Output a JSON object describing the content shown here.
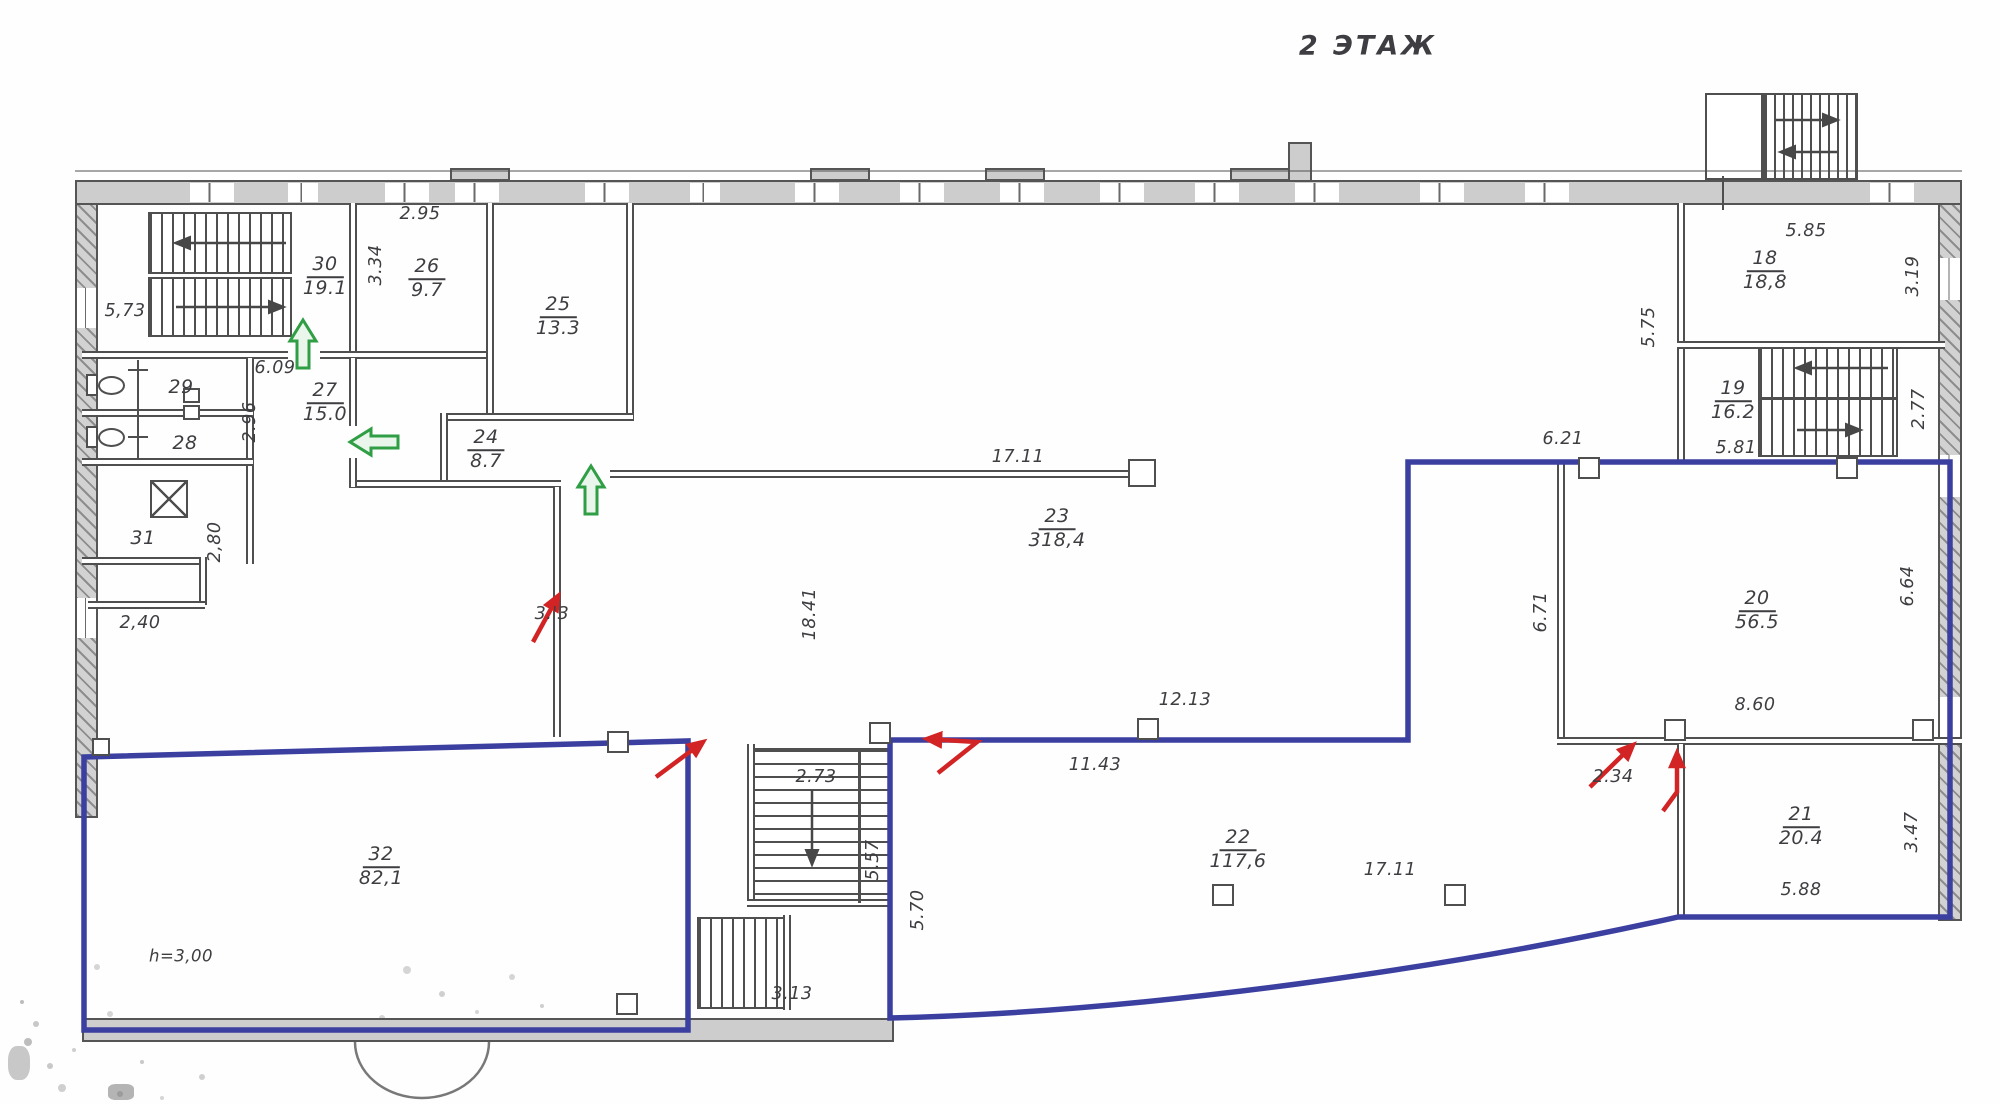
{
  "title": "2 ЭТАЖ",
  "rooms": {
    "r18": {
      "num": "18",
      "area": "18,8"
    },
    "r19": {
      "num": "19",
      "area": "16.2"
    },
    "r20": {
      "num": "20",
      "area": "56.5"
    },
    "r21": {
      "num": "21",
      "area": "20.4"
    },
    "r22": {
      "num": "22",
      "area": "117,6"
    },
    "r23": {
      "num": "23",
      "area": "318,4"
    },
    "r24": {
      "num": "24",
      "area": "8.7"
    },
    "r25": {
      "num": "25",
      "area": "13.3"
    },
    "r26": {
      "num": "26",
      "area": "9.7"
    },
    "r27": {
      "num": "27",
      "area": "15.0"
    },
    "r28": {
      "num": "28"
    },
    "r29": {
      "num": "29"
    },
    "r30": {
      "num": "30",
      "area": "19.1"
    },
    "r31": {
      "num": "31"
    },
    "r32": {
      "num": "32",
      "area": "82,1"
    }
  },
  "dimensions": {
    "d295": "2.95",
    "d334": "3.34",
    "d573": "5,73",
    "d609": "6.09",
    "d296": "2.96",
    "d280": "2,80",
    "d240": "2,40",
    "d1711_top": "17.11",
    "d1841": "18.41",
    "d3o3": "3.'3",
    "d273": "2.73",
    "d557": "5.57",
    "d570": "5.70",
    "d313": "3.13",
    "d1213": "12.13",
    "d1143": "11.43",
    "d1711_bottom": "17.11",
    "height_note": "h=3,00",
    "d585": "5.85",
    "d319": "3.19",
    "d575": "5.75",
    "d277": "2.77",
    "d581": "5.81",
    "d621": "6.21",
    "d671": "6.71",
    "d664": "6.64",
    "d860": "8.60",
    "d234": "2.34",
    "d347": "3.47",
    "d588": "5.88"
  },
  "annotations": {
    "highlight_outline_regions": 2,
    "red_arrow_count": 5,
    "green_arrow_count": 3
  },
  "colors": {
    "outline_blue": "#3b3fa0",
    "arrow_red": "#d22424",
    "arrow_green": "#2f9e44",
    "wall_fill": "#cdcdcd",
    "line_dark": "#4f4f4f",
    "text": "#3e3e42"
  }
}
